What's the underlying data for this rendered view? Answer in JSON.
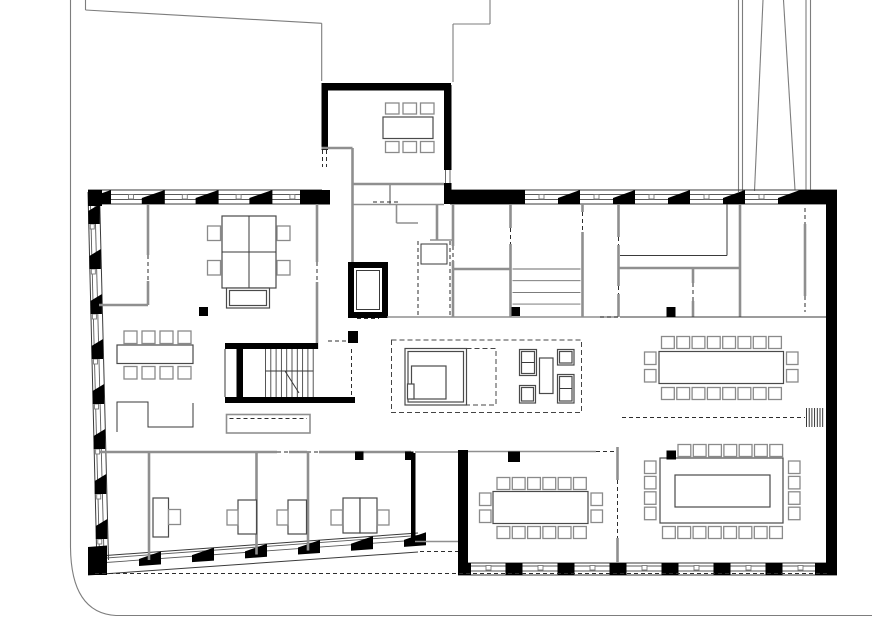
{
  "meta": {
    "type": "architectural-floor-plan",
    "view": "ground-floor office building plan, black and white line drawing",
    "canvas": {
      "width": 872,
      "height": 643
    }
  },
  "colors": {
    "wall": "#000000",
    "line": "#3a3a3a",
    "partition": "#8f8f8f",
    "furniture": "#4a4a4a",
    "chair": "#8a8a8a",
    "dashed": "#2d2d2d",
    "site": "#7d7d7d",
    "background": "#ffffff"
  },
  "inventory": {
    "north_annex_meeting_room": {
      "tables": 1,
      "chairs": 6
    },
    "west_open_office": {
      "desk_cluster_desks": 4,
      "desk_cluster_chairs": 4,
      "meeting_table_chairs": 8,
      "storage_cabinets": 2,
      "small_rooms": 2
    },
    "core": {
      "stair_flights": 2,
      "elevator": 1,
      "service_rooms_with_shelves": 1,
      "shaft": 1
    },
    "lounge_reception": {
      "reception_counter": 1,
      "armchairs": 4,
      "coffee_tables": 1
    },
    "conference_room_upper_east": {
      "tables": 1,
      "chairs": 20
    },
    "conference_room_lower_east": {
      "tables": 1,
      "chairs": 23
    },
    "conference_room_middle": {
      "tables": 1,
      "chairs": 16
    },
    "south_offices": {
      "offices": 3,
      "desks": 5,
      "chairs": 5
    },
    "columns": 8
  },
  "repeats": [
    {
      "target": "g-chairs-annex-top",
      "name": "chair",
      "type": "rect-row",
      "x": 385.5,
      "y": 103,
      "n": 3,
      "dx": 17.5,
      "dy": 0,
      "w": 13.5,
      "h": 11,
      "cls": "furn-g"
    },
    {
      "target": "g-chairs-annex-bottom",
      "name": "chair",
      "type": "rect-row",
      "x": 385.5,
      "y": 141.5,
      "n": 3,
      "dx": 17.5,
      "dy": 0,
      "w": 13.5,
      "h": 11,
      "cls": "furn-g"
    },
    {
      "target": "g-chairs-westconf-top",
      "name": "chair",
      "type": "rect-row",
      "x": 124,
      "y": 331,
      "n": 4,
      "dx": 18,
      "dy": 0,
      "w": 13,
      "h": 12.5,
      "cls": "furn-g"
    },
    {
      "target": "g-chairs-westconf-bottom",
      "name": "chair",
      "type": "rect-row",
      "x": 124,
      "y": 366.5,
      "n": 4,
      "dx": 18,
      "dy": 0,
      "w": 13,
      "h": 12.5,
      "cls": "furn-g"
    },
    {
      "target": "g-chairs-cluster-left",
      "name": "chair",
      "type": "rect-row",
      "x": 207.5,
      "y": 226,
      "n": 2,
      "dx": 0,
      "dy": 34.5,
      "w": 13,
      "h": 14.5,
      "cls": "furn-g"
    },
    {
      "target": "g-chairs-cluster-right",
      "name": "chair",
      "type": "rect-row",
      "x": 277,
      "y": 226,
      "n": 2,
      "dx": 0,
      "dy": 34.5,
      "w": 13,
      "h": 14.5,
      "cls": "furn-g"
    },
    {
      "target": "g-chairs-conf1-top",
      "name": "chair",
      "type": "rect-row",
      "x": 661.5,
      "y": 336.5,
      "n": 8,
      "dx": 15.3,
      "dy": 0,
      "w": 12.8,
      "h": 12,
      "cls": "furn-g"
    },
    {
      "target": "g-chairs-conf1-bottom",
      "name": "chair",
      "type": "rect-row",
      "x": 661.5,
      "y": 387.5,
      "n": 8,
      "dx": 15.3,
      "dy": 0,
      "w": 12.8,
      "h": 12,
      "cls": "furn-g"
    },
    {
      "target": "g-chairs-conf1-left",
      "name": "chair",
      "type": "rect-row",
      "x": 644.5,
      "y": 352,
      "n": 2,
      "dx": 0,
      "dy": 17.5,
      "w": 11.5,
      "h": 12.5,
      "cls": "furn-g"
    },
    {
      "target": "g-chairs-conf1-right",
      "name": "chair",
      "type": "rect-row",
      "x": 786.5,
      "y": 352,
      "n": 2,
      "dx": 0,
      "dy": 17.5,
      "w": 11.5,
      "h": 12.5,
      "cls": "furn-g"
    },
    {
      "target": "g-chairs-conf2-top",
      "name": "chair",
      "type": "rect-row",
      "x": 678,
      "y": 444.5,
      "n": 7,
      "dx": 15.3,
      "dy": 0,
      "w": 12.8,
      "h": 12,
      "cls": "furn-g"
    },
    {
      "target": "g-chairs-conf2-bottom",
      "name": "chair",
      "type": "rect-row",
      "x": 662.5,
      "y": 526.5,
      "n": 8,
      "dx": 15.3,
      "dy": 0,
      "w": 12.8,
      "h": 12,
      "cls": "furn-g"
    },
    {
      "target": "g-chairs-conf2-left",
      "name": "chair",
      "type": "rect-row",
      "x": 644.5,
      "y": 461,
      "n": 4,
      "dx": 0,
      "dy": 15.4,
      "w": 11.5,
      "h": 12.5,
      "cls": "furn-g"
    },
    {
      "target": "g-chairs-conf2-right",
      "name": "chair",
      "type": "rect-row",
      "x": 788.5,
      "y": 461,
      "n": 4,
      "dx": 0,
      "dy": 15.4,
      "w": 11.5,
      "h": 12.5,
      "cls": "furn-g"
    },
    {
      "target": "g-chairs-midconf-top",
      "name": "chair",
      "type": "rect-row",
      "x": 497,
      "y": 477.5,
      "n": 6,
      "dx": 15.3,
      "dy": 0,
      "w": 12.8,
      "h": 12,
      "cls": "furn-g"
    },
    {
      "target": "g-chairs-midconf-bottom",
      "name": "chair",
      "type": "rect-row",
      "x": 497,
      "y": 526.5,
      "n": 6,
      "dx": 15.3,
      "dy": 0,
      "w": 12.8,
      "h": 12,
      "cls": "furn-g"
    },
    {
      "target": "g-chairs-midconf-left",
      "name": "chair",
      "type": "rect-row",
      "x": 479.5,
      "y": 493,
      "n": 2,
      "dx": 0,
      "dy": 17,
      "w": 11.5,
      "h": 12.5,
      "cls": "furn-g"
    },
    {
      "target": "g-chairs-midconf-right",
      "name": "chair",
      "type": "rect-row",
      "x": 591,
      "y": 493,
      "n": 2,
      "dx": 0,
      "dy": 17,
      "w": 11.5,
      "h": 12.5,
      "cls": "furn-g"
    },
    {
      "target": "g-piers-north-left",
      "name": "wall-pier",
      "type": "wedge-row",
      "x": 88,
      "y": 190,
      "n": 5,
      "dx": 53.8,
      "w": 23,
      "h": 14,
      "lift": 8,
      "slope": 0
    },
    {
      "target": "g-piers-north-right",
      "name": "wall-pier",
      "type": "wedge-row",
      "x": 558,
      "y": 190,
      "n": 5,
      "dx": 55,
      "w": 22,
      "h": 14,
      "lift": 8,
      "slope": 0
    },
    {
      "target": "g-piers-sw-diag",
      "name": "wall-pier",
      "type": "wedge-row",
      "x": 139,
      "y": 553,
      "n": 6,
      "dx": 53,
      "w": 22,
      "h": 13,
      "lift": 6,
      "slope": -0.0721
    },
    {
      "target": "g-piers-west",
      "name": "wall-pier",
      "type": "wedge-col",
      "y": 204,
      "n": 8,
      "dy": 45,
      "w": 11.5,
      "h": 20,
      "lift": 7,
      "xBase": 88,
      "slopeX": 0.0239,
      "yRef": 192
    },
    {
      "target": "g-piers-south",
      "name": "wall-pier",
      "type": "rect-row",
      "x": 505.5,
      "y": 563,
      "n": 6,
      "dx": 52,
      "dy": 0,
      "w": 17,
      "h": 12,
      "fill": "#000"
    },
    {
      "target": "g-ticks-north-left",
      "name": "window-tick",
      "type": "rect-row",
      "x": 128.5,
      "y": 194.5,
      "n": 4,
      "dx": 53.8,
      "dy": 0,
      "w": 5,
      "h": 4.5,
      "cls": "glaz-tick"
    },
    {
      "target": "g-ticks-north-right",
      "name": "window-tick",
      "type": "rect-row",
      "x": 539,
      "y": 194.5,
      "n": 5,
      "dx": 55,
      "dy": 0,
      "w": 5,
      "h": 4.5,
      "cls": "glaz-tick"
    },
    {
      "target": "g-ticks-south",
      "name": "window-tick",
      "type": "rect-row",
      "x": 486,
      "y": 565.5,
      "n": 7,
      "dx": 52,
      "dy": 0,
      "w": 5,
      "h": 4.5,
      "cls": "glaz-tick"
    },
    {
      "target": "g-ticks-west",
      "name": "window-tick",
      "type": "tick-col-slant",
      "y": 224,
      "n": 8,
      "dy": 45,
      "w": 4,
      "h": 5,
      "xBase": 89.5,
      "slopeX": 0.0239,
      "yRef": 192
    },
    {
      "target": "g-stair-treads",
      "name": "stair-tread",
      "type": "line-col",
      "x": 265.5,
      "n": 10,
      "dx": 5.3,
      "y1": 349,
      "y2": 397,
      "stroke": "#444"
    },
    {
      "target": "g-core-shelves",
      "name": "shelf-line",
      "type": "line-row",
      "y": 269,
      "n": 4,
      "dy": 11.7,
      "x1": 512.5,
      "x2": 580.5,
      "stroke": "#6a6a6a"
    },
    {
      "target": "g-radiator-hatch",
      "name": "hatch-line",
      "type": "line-col",
      "x": 806.5,
      "n": 7,
      "dx": 2.7,
      "y1": 408,
      "y2": 427,
      "stroke": "#222"
    }
  ]
}
